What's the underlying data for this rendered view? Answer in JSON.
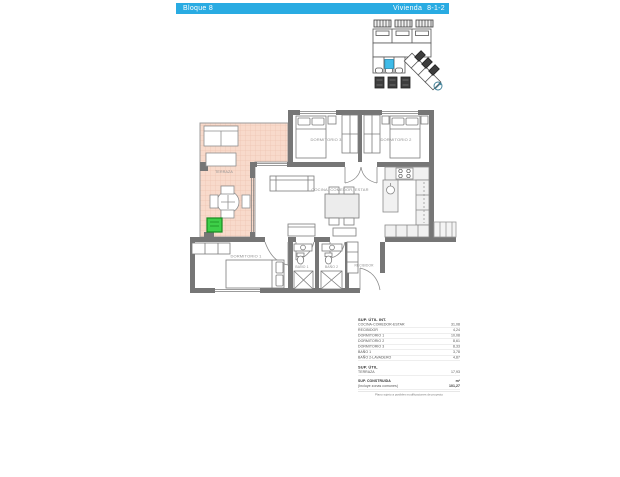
{
  "colors": {
    "accent_cyan": "#29abe2",
    "terrace_fill": "#f8dacb",
    "terrace_grid": "#eec4b1",
    "wall_gray": "#767676",
    "highlight_green": "#3ecf49",
    "label_gray": "#8f8f8f"
  },
  "header": {
    "block_label": "Bloque 8",
    "unit_prefix": "Vivienda",
    "unit_number": "8-1-2"
  },
  "plan": {
    "rooms": [
      {
        "label": "TERRAZA"
      },
      {
        "label": "DORMITORIO 3"
      },
      {
        "label": "DORMITORIO 2"
      },
      {
        "label": "COCINA, COMEDOR, ESTAR"
      },
      {
        "label": "DORMITORIO 1"
      },
      {
        "label": "BAÑO 1"
      },
      {
        "label": "BAÑO 2"
      },
      {
        "label": "RECIBIDOR"
      }
    ]
  },
  "areas_table": {
    "section_int_title": "SUP. ÚTIL INT.",
    "rows": [
      {
        "label": "COCINA-COMEDOR-ESTAR",
        "value": "31,08"
      },
      {
        "label": "RECIBIDOR",
        "value": "4,24"
      },
      {
        "label": "DORMITORIO 1",
        "value": "10,08"
      },
      {
        "label": "DORMITORIO 2",
        "value": "8,61"
      },
      {
        "label": "DORMITORIO 3",
        "value": "8,33"
      },
      {
        "label": "BAÑO 1",
        "value": "3,78"
      },
      {
        "label": "BAÑO 2-LAVADERO",
        "value": "4,87"
      }
    ],
    "section_util_title": "SUP. ÚTIL",
    "terraza_row": {
      "label": "TERRAZA",
      "value": "17,93"
    },
    "construida_row": {
      "label": "SUP. CONSTRUIDA",
      "unit": "m²",
      "sublabel": "(Incluye zonas comunes)",
      "value": "101,27"
    },
    "note": "Plano sujeto a posibles modificaciones de proyecto"
  }
}
